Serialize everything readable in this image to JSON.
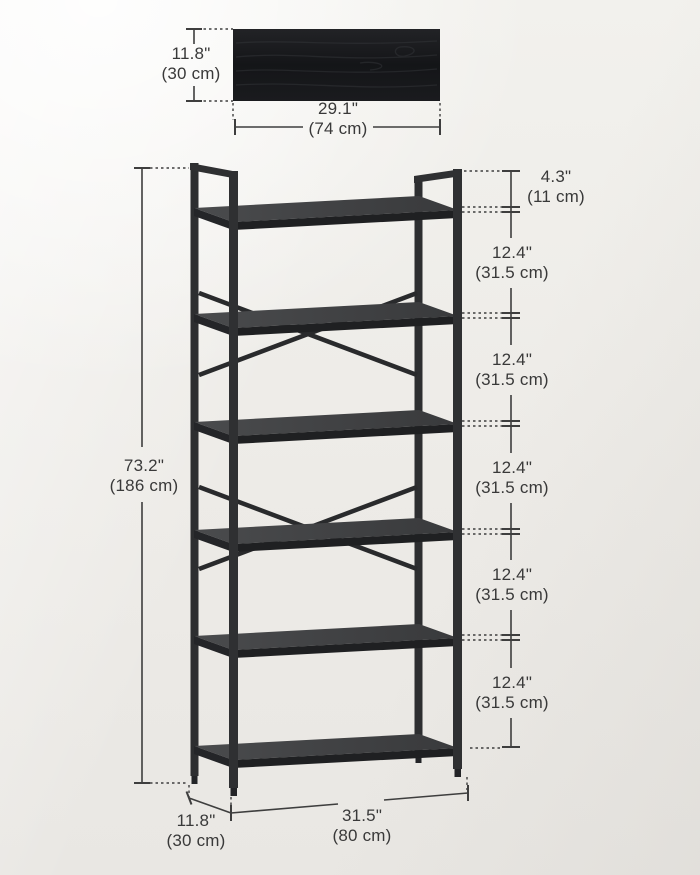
{
  "labels": {
    "panel_height": {
      "in": "11.8\"",
      "cm": "(30 cm)"
    },
    "panel_width": {
      "in": "29.1\"",
      "cm": "(74 cm)"
    },
    "top_gap": {
      "in": "4.3\"",
      "cm": "(11 cm)"
    },
    "shelf_gaps": [
      {
        "in": "12.4\"",
        "cm": "(31.5 cm)"
      },
      {
        "in": "12.4\"",
        "cm": "(31.5 cm)"
      },
      {
        "in": "12.4\"",
        "cm": "(31.5 cm)"
      },
      {
        "in": "12.4\"",
        "cm": "(31.5 cm)"
      },
      {
        "in": "12.4\"",
        "cm": "(31.5 cm)"
      }
    ],
    "total_height": {
      "in": "73.2\"",
      "cm": "(186 cm)"
    },
    "base_depth": {
      "in": "11.8\"",
      "cm": "(30 cm)"
    },
    "base_width": {
      "in": "31.5\"",
      "cm": "(80 cm)"
    }
  },
  "colors": {
    "background": "#efedea",
    "frame_metal": "#2f3032",
    "board_top": "#434446",
    "board_edge": "#1f2022",
    "panel_wood": "#17181a",
    "dimension_line": "#3e3e3e",
    "text": "#393939"
  }
}
